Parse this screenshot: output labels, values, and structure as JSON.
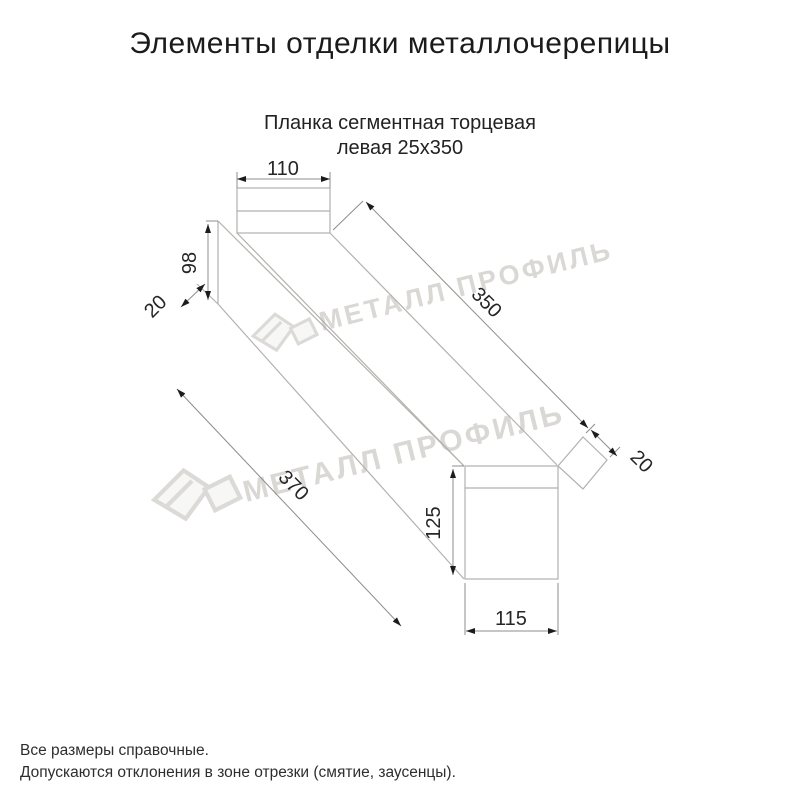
{
  "page": {
    "title": "Элементы отделки металлочерепицы"
  },
  "product": {
    "subtitle_line1": "Планка сегментная торцевая",
    "subtitle_line2": "левая 25х350"
  },
  "dimensions": {
    "top_flange_width": "110",
    "end_height": "98",
    "end_lip": "20",
    "top_edge_length": "350",
    "bottom_edge_length": "370",
    "far_lip": "20",
    "face_height": "125",
    "face_width": "115"
  },
  "watermark": {
    "brand_text": "МЕТАЛЛ ПРОФИЛЬ"
  },
  "footer": {
    "note1": "Все размеры справочные.",
    "note2": "Допускаются отклонения в зоне отрезки (смятие, заусенцы)."
  },
  "colors": {
    "background": "#ffffff",
    "sketch_line": "#b3b1ae",
    "dimension_line": "#8f8d8a",
    "dimension_text": "#262626",
    "arrow": "#1c1c1c",
    "title_text": "#1b1b1b",
    "watermark": "#d9d8d5"
  }
}
